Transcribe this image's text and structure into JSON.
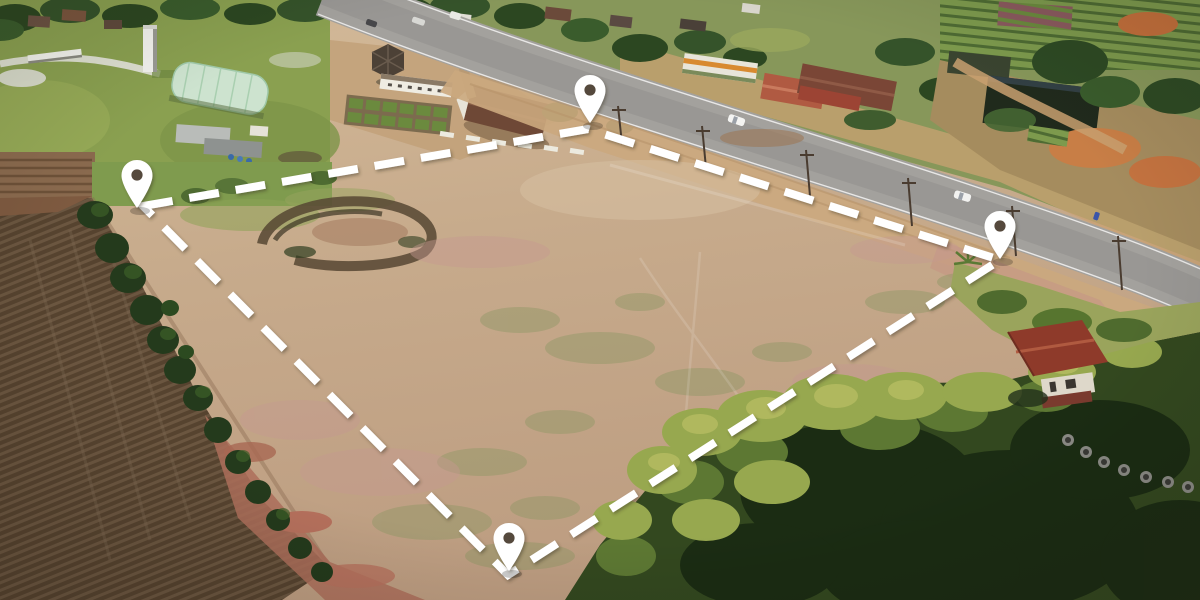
{
  "scene": {
    "title": "Aerial drone photo of a vacant land plot outlined with a dashed boundary and corner location pins, beside a highway, plowed farm field, farm buildings and bamboo grove",
    "canvas": {
      "width": 1200,
      "height": 600
    }
  },
  "overlay": {
    "boundary": {
      "color": "#ffffff",
      "stroke_width": 8,
      "dash": "30 17",
      "closed": true,
      "corners": [
        {
          "x": 143,
          "y": 206
        },
        {
          "x": 588,
          "y": 129
        },
        {
          "x": 1000,
          "y": 260
        },
        {
          "x": 508,
          "y": 575
        }
      ]
    },
    "pins": [
      {
        "id": "pin-left",
        "tip_x": 137,
        "tip_y": 209
      },
      {
        "id": "pin-top",
        "tip_x": 590,
        "tip_y": 124
      },
      {
        "id": "pin-right",
        "tip_x": 1000,
        "tip_y": 260
      },
      {
        "id": "pin-bottom",
        "tip_x": 509,
        "tip_y": 572
      }
    ],
    "pin_style": {
      "fill": "#ffffff",
      "hole": "#554a3c",
      "width": 34,
      "height": 50,
      "shadow_opacity": 0.22
    }
  },
  "palette": {
    "plot_soil": "#c7ab8c",
    "plot_soil_light": "#d6bf9f",
    "plot_soil_pink": "#c49a8c",
    "plowed_field": "#56432f",
    "furrow_light": "#6b5640",
    "red_dirt": "#ad6e5a",
    "orange_dirt": "#c47d46",
    "highway_asphalt": "#a3a19d",
    "shoulder_dirt": "#cba97e",
    "grass_park": "#8aa050",
    "tree_dark": "#2c4721",
    "bamboo_bright": "#97a84f",
    "bamboo_dark": "#1c2a13",
    "greenhouse": "#cde3cf",
    "barn_roof": "#6e4836",
    "house_roof_red": "#8e3a2a",
    "white_structure": "#efece2"
  }
}
